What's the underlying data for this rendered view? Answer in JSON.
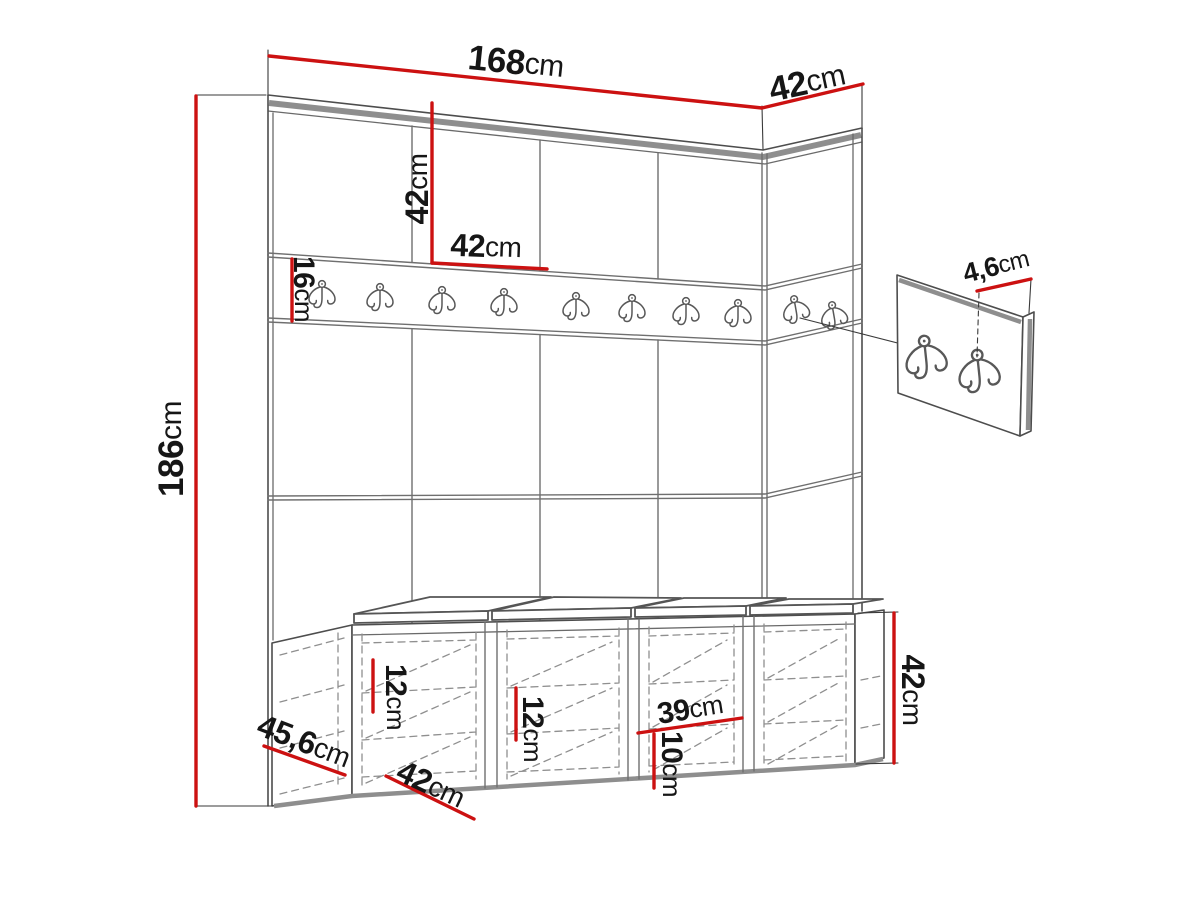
{
  "diagram": {
    "description": "Hallway wardrobe set dimension drawing: upholstered panel wall with coat hook rail, hook detail panel and shoe storage bench with seat cushions",
    "unit": "cm",
    "colors": {
      "dimension_red": "#cc1111",
      "line_gray": "#4d4d4d",
      "band_gray": "#8e8e8e",
      "background": "#ffffff",
      "text": "#161616"
    },
    "wall": {
      "front_hook_count": 8,
      "side_hook_count": 2
    },
    "detail_panel": {
      "hook_count": 2
    },
    "bench": {
      "compartment_count": 4,
      "cushion_count": 4
    },
    "dimensions": {
      "total_width": {
        "value": "168",
        "unit": "cm"
      },
      "side_panel_width": {
        "value": "42",
        "unit": "cm"
      },
      "total_height": {
        "value": "186",
        "unit": "cm"
      },
      "panel_height": {
        "value": "42",
        "unit": "cm"
      },
      "panel_width": {
        "value": "42",
        "unit": "cm"
      },
      "rail_height": {
        "value": "16",
        "unit": "cm"
      },
      "hook_height": {
        "value": "4,6",
        "unit": "cm"
      },
      "bench_height": {
        "value": "42",
        "unit": "cm"
      },
      "bench_depth": {
        "value": "45,6",
        "unit": "cm"
      },
      "bench_compartment_width": {
        "value": "42",
        "unit": "cm"
      },
      "shelf_gap_left": {
        "value": "12",
        "unit": "cm"
      },
      "shelf_gap_middle": {
        "value": "12",
        "unit": "cm"
      },
      "shelf_width": {
        "value": "39",
        "unit": "cm"
      },
      "shelf_gap_right": {
        "value": "10",
        "unit": "cm"
      }
    }
  }
}
